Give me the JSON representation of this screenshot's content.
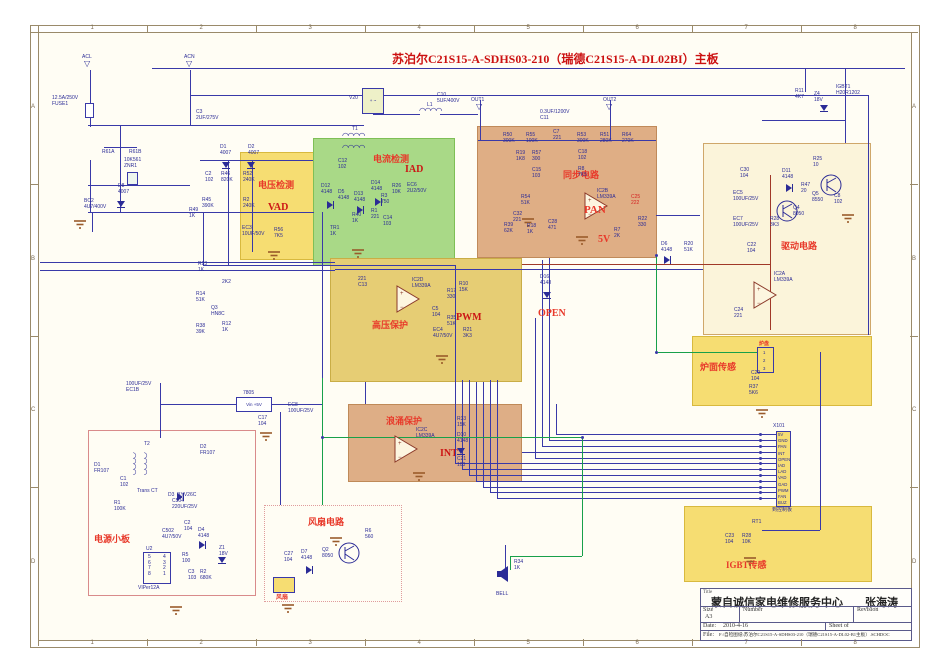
{
  "header": {
    "title": "苏泊尔C21S15-A-SDHS03-210（瑞德C21S15-A-DL02BI）主板"
  },
  "border": {
    "columns": [
      "1",
      "2",
      "3",
      "4",
      "5",
      "6",
      "7",
      "8"
    ],
    "rows": [
      "A",
      "B",
      "C",
      "D"
    ]
  },
  "colors": {
    "wire": "#3939a8",
    "green_wire": "#18a04a",
    "maroon_wire": "#a03828",
    "block_label": "#e8392a",
    "sub_label": "#cc1515",
    "part_text": "#2b2b96"
  },
  "blocks": [
    {
      "name": "voltage-detect-block",
      "x": 240,
      "y": 152,
      "w": 88,
      "h": 108,
      "bg": "#f6dd72",
      "bd": "#d8b93e",
      "label": "电压检测",
      "lx": 18,
      "ly": 26,
      "sub": "VAD",
      "sx": 28,
      "sy": 50
    },
    {
      "name": "current-detect-block",
      "x": 313,
      "y": 138,
      "w": 142,
      "h": 128,
      "bg": "#a9d987",
      "bd": "#7fbf56",
      "label": "电流检测",
      "lx": 60,
      "ly": 14,
      "sub": "IAD",
      "sx": 92,
      "sy": 26
    },
    {
      "name": "sync-circuit-block",
      "x": 477,
      "y": 126,
      "w": 180,
      "h": 132,
      "bg": "#dfae85",
      "bd": "#c08a5a",
      "label": "同步电路",
      "lx": 86,
      "ly": 42,
      "sub": "",
      "sx": 0,
      "sy": 0
    },
    {
      "name": "drive-circuit-block",
      "x": 703,
      "y": 143,
      "w": 168,
      "h": 192,
      "bg": "#fbf4da",
      "bd": "#cfa76a",
      "label": "驱动电路",
      "lx": 78,
      "ly": 96,
      "sub": "",
      "sx": 0,
      "sy": 0
    },
    {
      "name": "hv-protect-block",
      "x": 330,
      "y": 258,
      "w": 192,
      "h": 124,
      "bg": "#e6cd74",
      "bd": "#c9ad46",
      "label": "高压保护",
      "lx": 42,
      "ly": 60,
      "sub": "PWM",
      "sx": 126,
      "sy": 54
    },
    {
      "name": "surge-protect-block",
      "x": 348,
      "y": 404,
      "w": 174,
      "h": 78,
      "bg": "#deae86",
      "bd": "#bf8a58",
      "label": "浪涌保护",
      "lx": 38,
      "ly": 10,
      "sub": "INT",
      "sx": 92,
      "sy": 44
    },
    {
      "name": "pan-sensor-block",
      "x": 692,
      "y": 336,
      "w": 180,
      "h": 70,
      "bg": "#f6dd72",
      "bd": "#d8b93e",
      "label": "炉面传感",
      "lx": 8,
      "ly": 24,
      "sub": "",
      "sx": 0,
      "sy": 0
    },
    {
      "name": "igbt-sensor-block",
      "x": 684,
      "y": 506,
      "w": 188,
      "h": 76,
      "bg": "#f6dd72",
      "bd": "#d8b93e",
      "label": "IGBT传感",
      "lx": 42,
      "ly": 52,
      "sub": "",
      "sx": 0,
      "sy": 0
    },
    {
      "name": "psu-board-block",
      "x": 88,
      "y": 430,
      "w": 168,
      "h": 166,
      "bg": "rgba(255,255,255,0)",
      "bd": "#d98b8b",
      "label": "电源小板",
      "lx": 6,
      "ly": 102,
      "sub": "",
      "sx": 0,
      "sy": 0
    },
    {
      "name": "fan-circuit-block",
      "x": 264,
      "y": 505,
      "w": 138,
      "h": 97,
      "bg": "rgba(255,255,255,0)",
      "bd": "#e09c9c",
      "label": "风扇电路",
      "lx": 44,
      "ly": 10,
      "sub": "",
      "sx": 0,
      "sy": 0,
      "dotted": true
    }
  ],
  "red_labels": [
    {
      "t": "PAN",
      "x": 584,
      "y": 204,
      "s": 11
    },
    {
      "t": "5V",
      "x": 598,
      "y": 234,
      "s": 10
    },
    {
      "t": "OPEN",
      "x": 538,
      "y": 308,
      "s": 10
    },
    {
      "t": "风扇",
      "x": 276,
      "y": 592,
      "s": 6
    },
    {
      "t": "炉盘",
      "x": 759,
      "y": 340,
      "s": 5
    }
  ],
  "parts": [
    [
      "ACL",
      82,
      55
    ],
    [
      "ACN",
      184,
      55
    ],
    [
      "12.5A/250V\nFUSE1",
      52,
      96
    ],
    [
      "10K561\nZNR1",
      124,
      158
    ],
    [
      "C3\n2UF/275V",
      196,
      110
    ],
    [
      "R61A",
      102,
      150
    ],
    [
      "R61B",
      129,
      150
    ],
    [
      "D8\n4007",
      118,
      184
    ],
    [
      "BC2\n4U7/400V",
      84,
      199
    ],
    [
      "D1\n4007",
      220,
      145
    ],
    [
      "D2\n4007",
      248,
      145
    ],
    [
      "C2\n102",
      205,
      172
    ],
    [
      "R46\n820K",
      221,
      172
    ],
    [
      "R45\n390K",
      202,
      198
    ],
    [
      "R49\n1K",
      189,
      208
    ],
    [
      "R52\n240K",
      243,
      172
    ],
    [
      "R2\n240K",
      243,
      198
    ],
    [
      "EC3\n10UF/50V",
      242,
      226
    ],
    [
      "R56\n7K5",
      274,
      228
    ],
    [
      "R23\n1K",
      198,
      262
    ],
    [
      "2K2",
      222,
      280
    ],
    [
      "R14\n51K",
      196,
      292
    ],
    [
      "Q3\nHN8C",
      211,
      306
    ],
    [
      "R38\n39K",
      196,
      324
    ],
    [
      "R12\n1K",
      222,
      322
    ],
    [
      "V20",
      349,
      96
    ],
    [
      "L1",
      427,
      103
    ],
    [
      "C10\n5UF/400V",
      437,
      93
    ],
    [
      "T1",
      352,
      127
    ],
    [
      "C12\n102",
      338,
      159
    ],
    [
      "D12\n4148",
      321,
      184
    ],
    [
      "D5\n4148",
      338,
      190
    ],
    [
      "D13\n4148",
      354,
      192
    ],
    [
      "D14\n4148",
      371,
      181
    ],
    [
      "R3\n750",
      381,
      194
    ],
    [
      "R1\n221",
      371,
      209
    ],
    [
      "C14\n103",
      383,
      216
    ],
    [
      "R40\n1K",
      352,
      213
    ],
    [
      "TR1\n1K",
      330,
      226
    ],
    [
      "R26\n10K",
      392,
      184
    ],
    [
      "EC6\n2U2/50V",
      407,
      183
    ],
    [
      "0.3UF/1200V\nC11",
      540,
      110
    ],
    [
      "OUT1",
      471,
      98
    ],
    [
      "OUT2",
      603,
      98
    ],
    [
      "R50\n300K",
      503,
      133
    ],
    [
      "R55\n100K",
      526,
      133
    ],
    [
      "C7\n221",
      553,
      130
    ],
    [
      "R53\n300K",
      577,
      133
    ],
    [
      "R51\n280K",
      600,
      133
    ],
    [
      "R64\n270K",
      622,
      133
    ],
    [
      "R19\n1K8",
      516,
      151
    ],
    [
      "R57\n300",
      532,
      151
    ],
    [
      "C15\n103",
      532,
      168
    ],
    [
      "C18\n102",
      578,
      150
    ],
    [
      "R8\n7K5",
      578,
      167
    ],
    [
      "R54\n51K",
      521,
      195
    ],
    [
      "C32\n221",
      513,
      212
    ],
    [
      "R39\n62K",
      504,
      223
    ],
    [
      "R18\n1K",
      527,
      224
    ],
    [
      "C28\n471",
      548,
      220
    ],
    [
      "IC2B\nLM339A",
      597,
      189
    ],
    [
      "C25\n222",
      631,
      195,
      1
    ],
    [
      "R22\n330",
      638,
      217
    ],
    [
      "R7\n2K",
      614,
      228
    ],
    [
      "D6\n4148",
      661,
      242
    ],
    [
      "R20\n51K",
      684,
      242
    ],
    [
      "R25\n10",
      813,
      157
    ],
    [
      "C30\n104",
      740,
      168
    ],
    [
      "D11\n4148",
      782,
      169
    ],
    [
      "R47\n20",
      801,
      183
    ],
    [
      "Q5\n8550",
      812,
      192
    ],
    [
      "C8\n102",
      834,
      194
    ],
    [
      "Q4\n8050",
      793,
      206
    ],
    [
      "EC5\n100UF/25V",
      733,
      191
    ],
    [
      "EC7\n100UF/25V",
      733,
      217
    ],
    [
      "R28\n3K3",
      770,
      217
    ],
    [
      "C22\n104",
      747,
      243
    ],
    [
      "IC2A\nLM339A",
      774,
      272
    ],
    [
      "C24\n221",
      734,
      308
    ],
    [
      "R11\n4K7",
      795,
      89
    ],
    [
      "Z4\n18V",
      814,
      92
    ],
    [
      "IGBT1\nH20R1202",
      836,
      85
    ],
    [
      "221\nC13",
      358,
      277
    ],
    [
      "IC2D\nLM339A",
      412,
      278
    ],
    [
      "R17\n330",
      447,
      289
    ],
    [
      "R10\n15K",
      459,
      282
    ],
    [
      "C5\n104",
      432,
      307
    ],
    [
      "R35\n51K",
      447,
      316
    ],
    [
      "EC4\n4U7/50V",
      433,
      328
    ],
    [
      "R21\n3K3",
      463,
      328
    ],
    [
      "D16\n4148",
      540,
      275
    ],
    [
      "IC2C\nLM339A",
      416,
      428
    ],
    [
      "R33\n15K",
      457,
      417
    ],
    [
      "D10\n4148",
      457,
      433
    ],
    [
      "C21\n103",
      457,
      457
    ],
    [
      "T2",
      144,
      442
    ],
    [
      "D2\nFR107",
      200,
      445
    ],
    [
      "D1\nFR107",
      94,
      463
    ],
    [
      "C1\n102",
      120,
      477
    ],
    [
      "Trans CT",
      137,
      489
    ],
    [
      "D3  BYV26C",
      168,
      493
    ],
    [
      "R1\n100K",
      114,
      501
    ],
    [
      "C504\n220UF/25V",
      172,
      499
    ],
    [
      "C2\n104",
      184,
      521
    ],
    [
      "D4\n4148",
      198,
      528
    ],
    [
      "C502\n4U7/50V",
      162,
      529
    ],
    [
      "Z1\n18V",
      219,
      546
    ],
    [
      "U2",
      146,
      547
    ],
    [
      "R5\n100",
      182,
      553
    ],
    [
      "5\n6\n7\n8",
      148,
      555
    ],
    [
      "4\n3\n2\n1",
      163,
      555
    ],
    [
      "C3\n103",
      188,
      570
    ],
    [
      "R2\n680K",
      200,
      570
    ],
    [
      "VIPer12A",
      138,
      586
    ],
    [
      "R6\n560",
      365,
      529
    ],
    [
      "Q2\n8050",
      322,
      548
    ],
    [
      "C27\n104",
      284,
      552
    ],
    [
      "D7\n4148",
      301,
      550
    ],
    [
      "C29\n104",
      751,
      371
    ],
    [
      "R37\n5K6",
      749,
      385
    ],
    [
      "RT1",
      752,
      520
    ],
    [
      "C23\n104",
      725,
      534
    ],
    [
      "R28\n10K",
      742,
      534
    ],
    [
      "R34\n1K",
      514,
      560
    ],
    [
      "BELL",
      496,
      592
    ],
    [
      "7805",
      243,
      391
    ],
    [
      "EC8\n100UF/25V",
      288,
      403
    ],
    [
      "100UF/25V\nEC1B",
      126,
      382
    ],
    [
      "C17\n104",
      258,
      416
    ],
    [
      "X101",
      773,
      424
    ],
    [
      "到控制板",
      772,
      508
    ]
  ],
  "wires": {
    "blue_h": [
      [
        152,
        68,
        753
      ],
      [
        190,
        95,
        186
      ],
      [
        384,
        95,
        484
      ],
      [
        88,
        125,
        276
      ],
      [
        88,
        185,
        102
      ],
      [
        88,
        212,
        226
      ],
      [
        373,
        114,
        47
      ],
      [
        440,
        114,
        38
      ],
      [
        478,
        140,
        178
      ],
      [
        200,
        160,
        113
      ],
      [
        203,
        265,
        252
      ],
      [
        40,
        262,
        295
      ],
      [
        40,
        270,
        295
      ],
      [
        335,
        269,
        368
      ],
      [
        160,
        404,
        76
      ],
      [
        270,
        404,
        52
      ],
      [
        104,
        147,
        33
      ],
      [
        762,
        120,
        83
      ],
      [
        656,
        215,
        44
      ],
      [
        556,
        434,
        221
      ],
      [
        549,
        440,
        228
      ],
      [
        542,
        446,
        235
      ],
      [
        522,
        452,
        255
      ],
      [
        535,
        458,
        242
      ],
      [
        455,
        463,
        322
      ],
      [
        462,
        469,
        315
      ],
      [
        469,
        475,
        308
      ],
      [
        476,
        481,
        301
      ],
      [
        483,
        487,
        294
      ],
      [
        490,
        492,
        287
      ],
      [
        497,
        498,
        280
      ],
      [
        762,
        530,
        58
      ]
    ],
    "blue_v": [
      [
        90,
        70,
        57
      ],
      [
        190,
        70,
        55
      ],
      [
        90,
        160,
        52
      ],
      [
        120,
        125,
        87
      ],
      [
        92,
        212,
        20
      ],
      [
        228,
        160,
        105
      ],
      [
        252,
        160,
        92
      ],
      [
        480,
        100,
        40
      ],
      [
        610,
        100,
        40
      ],
      [
        455,
        265,
        198
      ],
      [
        462,
        380,
        89
      ],
      [
        469,
        380,
        95
      ],
      [
        476,
        382,
        99
      ],
      [
        483,
        382,
        105
      ],
      [
        490,
        380,
        112
      ],
      [
        497,
        380,
        118
      ],
      [
        535,
        318,
        140
      ],
      [
        542,
        260,
        186
      ],
      [
        549,
        258,
        182
      ],
      [
        556,
        404,
        30
      ],
      [
        845,
        68,
        75
      ],
      [
        805,
        68,
        24
      ],
      [
        868,
        95,
        240
      ],
      [
        322,
        212,
        166
      ],
      [
        203,
        212,
        53
      ],
      [
        160,
        383,
        55
      ],
      [
        280,
        412,
        93
      ],
      [
        505,
        545,
        25
      ],
      [
        365,
        382,
        22
      ],
      [
        820,
        352,
        156
      ],
      [
        820,
        508,
        22
      ]
    ],
    "green_h": [
      [
        322,
        437,
        260
      ],
      [
        510,
        556,
        72
      ],
      [
        656,
        352,
        102
      ]
    ],
    "green_v": [
      [
        322,
        378,
        127
      ],
      [
        582,
        437,
        119
      ],
      [
        656,
        255,
        97
      ],
      [
        510,
        556,
        14
      ]
    ],
    "maroon_h": [
      [
        522,
        264,
        248
      ]
    ],
    "maroon_v": [
      [
        770,
        175,
        155
      ]
    ],
    "dots": [
      [
        760,
        434
      ],
      [
        760,
        440
      ],
      [
        760,
        446
      ],
      [
        760,
        452
      ],
      [
        760,
        458
      ],
      [
        760,
        463
      ],
      [
        760,
        469
      ],
      [
        760,
        475
      ],
      [
        760,
        481
      ],
      [
        760,
        487
      ],
      [
        760,
        492
      ],
      [
        760,
        498
      ],
      [
        322,
        437
      ],
      [
        582,
        437
      ],
      [
        656,
        352
      ],
      [
        656,
        255
      ]
    ]
  },
  "symbols": {
    "opamps": [
      {
        "x": 584,
        "y": 192
      },
      {
        "x": 753,
        "y": 281
      },
      {
        "x": 396,
        "y": 285
      },
      {
        "x": 394,
        "y": 435
      }
    ],
    "npn": [
      {
        "x": 819,
        "y": 173
      },
      {
        "x": 775,
        "y": 199
      },
      {
        "x": 337,
        "y": 541
      }
    ],
    "grounds": [
      [
        74,
        216
      ],
      [
        268,
        247
      ],
      [
        352,
        245
      ],
      [
        522,
        214
      ],
      [
        436,
        351
      ],
      [
        413,
        468
      ],
      [
        330,
        533
      ],
      [
        282,
        600
      ],
      [
        170,
        602
      ],
      [
        260,
        428
      ],
      [
        842,
        210
      ],
      [
        756,
        405
      ],
      [
        744,
        553
      ],
      [
        576,
        232
      ]
    ],
    "diodes": [
      {
        "x": 222,
        "y": 157,
        "d": "d"
      },
      {
        "x": 247,
        "y": 157,
        "d": "d"
      },
      {
        "x": 117,
        "y": 196,
        "d": "d"
      },
      {
        "x": 327,
        "y": 196,
        "d": "r"
      },
      {
        "x": 357,
        "y": 201,
        "d": "r"
      },
      {
        "x": 375,
        "y": 193,
        "d": "r"
      },
      {
        "x": 664,
        "y": 251,
        "d": "r"
      },
      {
        "x": 543,
        "y": 287,
        "d": "d"
      },
      {
        "x": 457,
        "y": 443,
        "d": "d"
      },
      {
        "x": 786,
        "y": 179,
        "d": "r"
      },
      {
        "x": 306,
        "y": 561,
        "d": "r"
      },
      {
        "x": 199,
        "y": 536,
        "d": "r"
      },
      {
        "x": 177,
        "y": 488,
        "d": "r"
      },
      {
        "x": 218,
        "y": 552,
        "d": "d"
      },
      {
        "x": 820,
        "y": 100,
        "d": "d"
      }
    ],
    "coils_h": [
      {
        "x": 419,
        "y": 108
      },
      {
        "x": 342,
        "y": 133
      },
      {
        "x": 342,
        "y": 145
      }
    ],
    "coils_v": [
      {
        "x": 136,
        "y": 452
      },
      {
        "x": 147,
        "y": 452
      }
    ],
    "arrows": [
      {
        "x": 84,
        "y": 60,
        "g": "▽"
      },
      {
        "x": 186,
        "y": 60,
        "g": "▽"
      },
      {
        "x": 476,
        "y": 103,
        "g": "▽"
      },
      {
        "x": 606,
        "y": 103,
        "g": "▽"
      }
    ],
    "boxes": [
      {
        "name": "bridge-rectifier-box",
        "x": 362,
        "y": 88,
        "w": 22,
        "h": 26,
        "bg": "#eef0c8",
        "text": "+ ~"
      },
      {
        "name": "regulator-7805-box",
        "x": 236,
        "y": 397,
        "w": 36,
        "h": 15,
        "bg": "#ffffff",
        "text": "Vin  +5V"
      },
      {
        "name": "viper12a-box",
        "x": 143,
        "y": 552,
        "w": 28,
        "h": 32,
        "bg": "#fffdf0",
        "text": ""
      },
      {
        "name": "fuse-box",
        "x": 85,
        "y": 103,
        "w": 9,
        "h": 15,
        "bg": "#ffffff",
        "text": ""
      },
      {
        "name": "varistor-box",
        "x": 127,
        "y": 172,
        "w": 11,
        "h": 13,
        "bg": "#eef6ee",
        "text": ""
      }
    ],
    "speaker": {
      "x": 496,
      "y": 566
    }
  },
  "connectors": {
    "x101": {
      "x": 776,
      "y": 431,
      "w": 15,
      "h": 76,
      "pins": [
        "5V",
        "GND",
        "PAN",
        "INT",
        "OPEN",
        "IAD",
        "LAD",
        "VAD",
        "GAD",
        "PWM",
        "FAN",
        "BUZ"
      ]
    },
    "pan": {
      "x": 757,
      "y": 347,
      "w": 17,
      "h": 26,
      "pins": [
        "1",
        "2",
        "3"
      ]
    },
    "fan": {
      "x": 273,
      "y": 577,
      "w": 22,
      "h": 16,
      "pins": []
    }
  },
  "title_block": {
    "title_label": "Title",
    "company": "蒙自诚信家电维修服务中心　　张海涛",
    "size_label": "Size",
    "size": "A3",
    "number_label": "Number",
    "revision_label": "Revision",
    "date_label": "Date:",
    "date": "2010-4-16",
    "sheet_label": "Sheet   of",
    "file_label": "File:",
    "file": "F:\\自检图纸\\苏泊尔C21S15-A-SDHS03-210（瑞德C21S15-A-DL02-B1主板）.SCHDOC"
  }
}
